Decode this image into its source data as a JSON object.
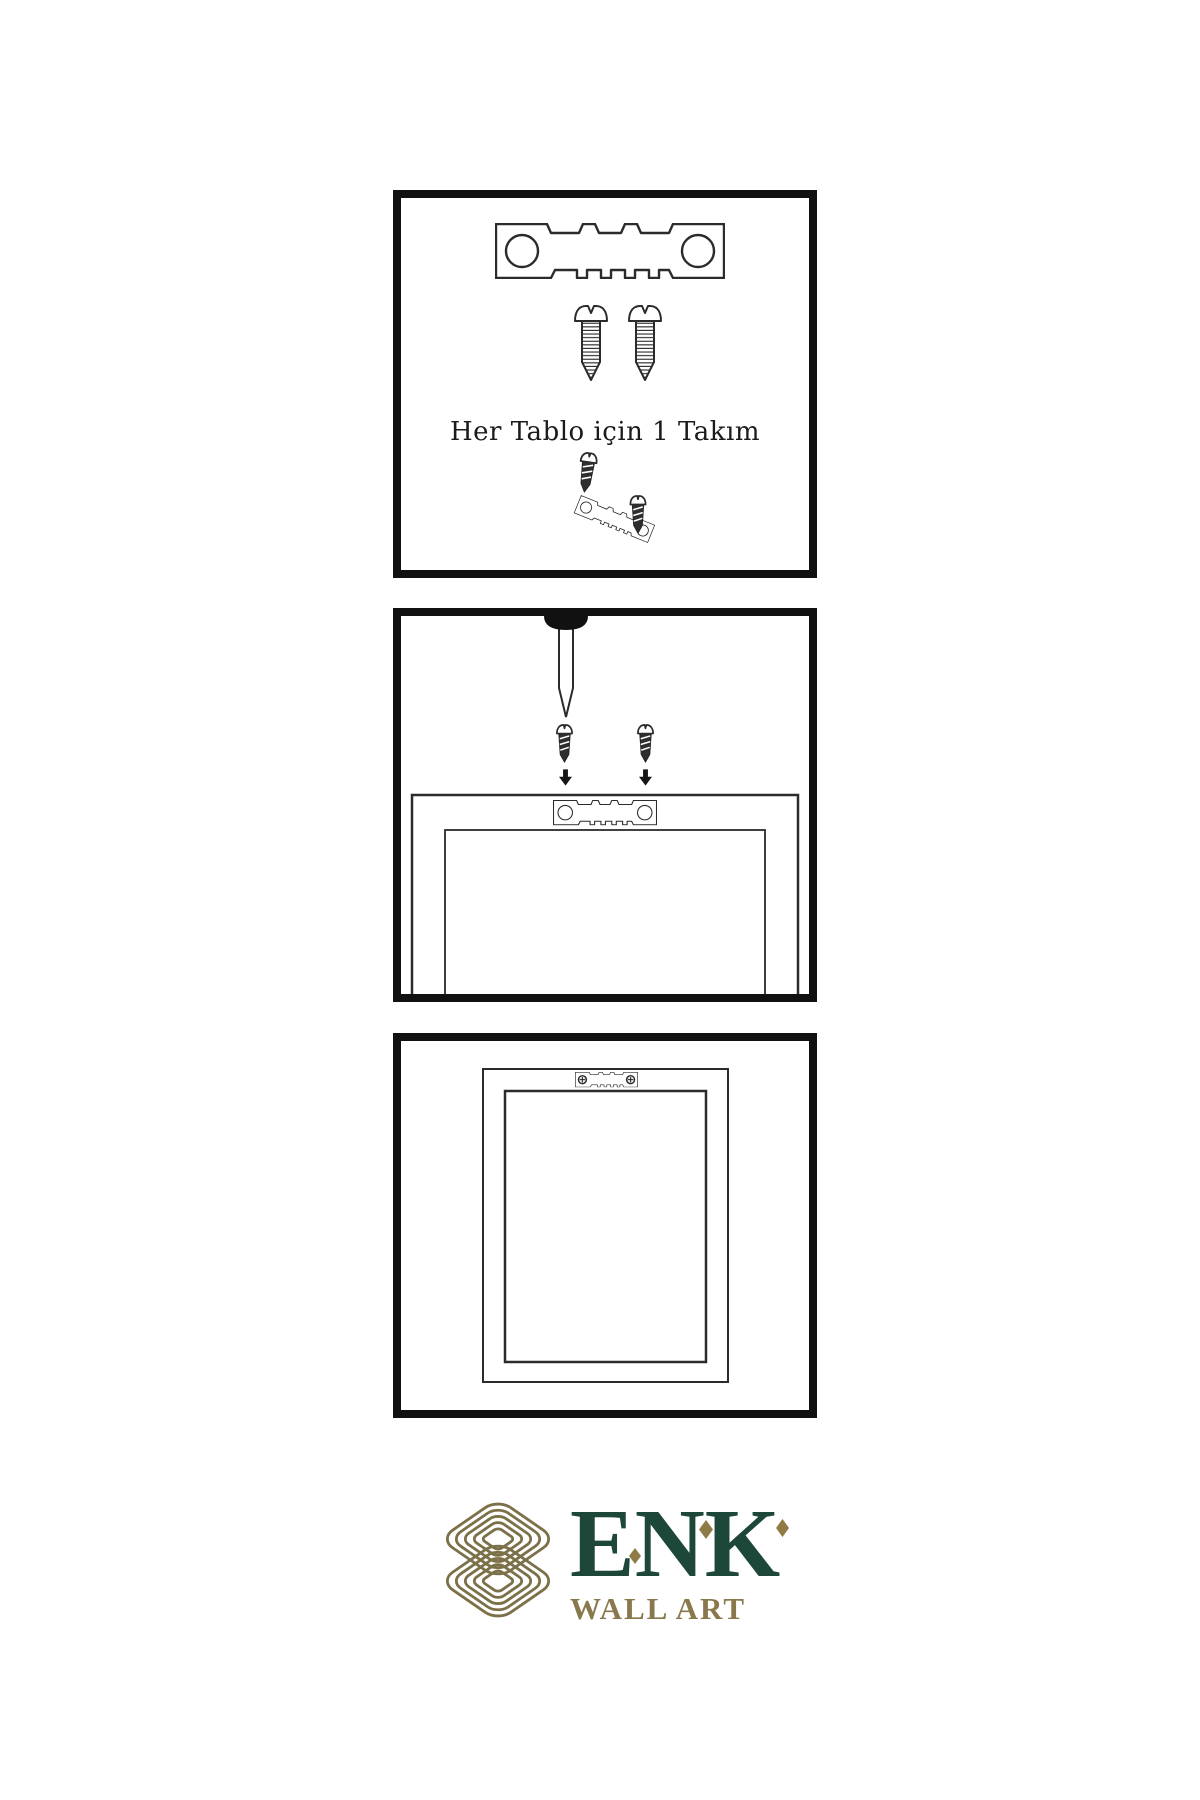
{
  "page": {
    "background": "#ffffff",
    "width": 1200,
    "height": 1800
  },
  "steps": [
    {
      "name": "hardware-set",
      "caption": "Her Tablo için 1 Takım",
      "items": [
        "sawtooth-hanger",
        "mounting-screw",
        "mounting-screw",
        "screw-being-driven",
        "tilted-sawtooth-hanger",
        "mounting-screw-dark"
      ]
    },
    {
      "name": "attach-hanger-to-frame",
      "caption": "",
      "items": [
        "wall-nail",
        "mounting-screw-dark",
        "mounting-screw-dark",
        "down-arrow",
        "down-arrow",
        "frame-back-with-sawtooth-hanger"
      ]
    },
    {
      "name": "hang-frame-on-wall",
      "caption": "",
      "items": [
        "frame-back-with-installed-sawtooth-hanger",
        "phillips-screw-head",
        "phillips-screw-head"
      ]
    }
  ],
  "brand": {
    "name": "ENK",
    "tagline": "WALL ART",
    "knot_color": "#7c7048",
    "name_color": "#1d4738",
    "tagline_color": "#8a784d",
    "diamond_color": "#8f7b45"
  },
  "colors": {
    "panel_border": "#111111",
    "line": "#2b2b2b",
    "dark_fill": "#2e2e2e",
    "background": "#ffffff"
  }
}
